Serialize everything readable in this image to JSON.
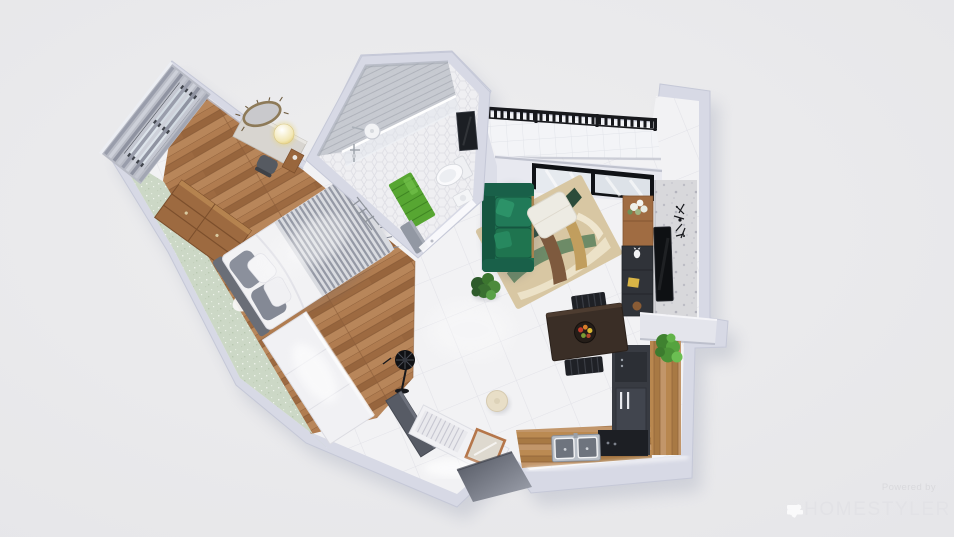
{
  "app": {
    "name": "Homestyler 3D floor plan render"
  },
  "canvas": {
    "width": 954,
    "height": 537,
    "background": "#e9e9eb"
  },
  "watermark": {
    "powered_by": "Powered by",
    "brand": "HOMESTYLER",
    "logo": "homestyler-fan-icon",
    "text_color": "#e2e2e6",
    "muted_color": "#d9d9dd"
  },
  "palette": {
    "wall": "#d7d9e5",
    "wall_shadow": "#b9bcce",
    "wood_floor": "#a9764c",
    "tile_floor": "#f2f2f4",
    "mint_carpet": "#ccd8c6",
    "sofa_green": "#1d6e4f",
    "rug_tan": "#d8c7a3",
    "grass_mat": "#57a632",
    "railing_black": "#17181c",
    "counter_wood": "#b2844f",
    "appliance_dark": "#383b42",
    "copper_frame": "#b5764a"
  },
  "scene": {
    "type": "3d-floorplan-top-view",
    "rooms": [
      {
        "id": "bedroom",
        "label": "Bedroom",
        "features": [
          "window-blinds",
          "desk",
          "desk-chair",
          "ornate-mirror",
          "pendant-lamp",
          "dresser",
          "double-bed",
          "wardrobe-led",
          "oval-rug",
          "mint-carpet"
        ]
      },
      {
        "id": "bathroom",
        "label": "Bathroom",
        "features": [
          "walk-in-shower",
          "glass-partition",
          "shower-head",
          "towel-ladder",
          "grass-mat",
          "toilet",
          "dark-mirror",
          "vanity",
          "bench",
          "hex-tile-floor"
        ]
      },
      {
        "id": "balcony",
        "label": "Balcony",
        "features": [
          "black-metal-railing",
          "tile-floor"
        ]
      },
      {
        "id": "living-room",
        "label": "Living Room",
        "features": [
          "black-frame-window",
          "green-velvet-sofa",
          "white-ottoman",
          "abstract-rug",
          "potted-plant",
          "wall-tv",
          "dark-tv-cabinet",
          "wood-shelf",
          "sputnik-wall-clock",
          "terrazzo-wall"
        ]
      },
      {
        "id": "kitchen",
        "label": "Kitchen",
        "features": [
          "l-shaped-wood-counter",
          "double-sink",
          "refrigerator",
          "dark-appliance-run",
          "counter-plant",
          "dining-table",
          "fruit-plate",
          "two-black-chairs"
        ]
      },
      {
        "id": "entry-hall",
        "label": "Entry Hall",
        "features": [
          "standing-fan",
          "entry-door",
          "shoe-bench-led",
          "copper-leaning-mirror",
          "round-pouf",
          "dark-entry-niche",
          "wood-to-tile-floor"
        ]
      }
    ]
  }
}
